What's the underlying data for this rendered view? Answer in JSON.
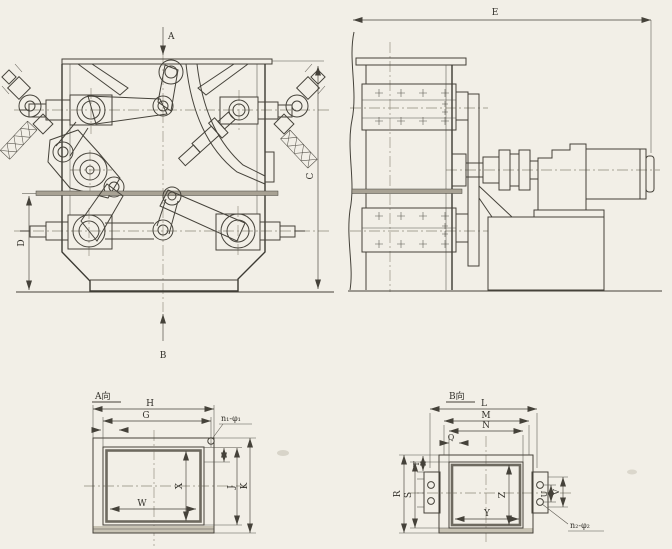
{
  "drawing": {
    "type": "mechanical-engineering-drawing",
    "paper_color": "#f2efe7",
    "ink_color": "#45423a",
    "centerline_color": "#8f8a7b",
    "views": {
      "front": {
        "label_a": "A",
        "label_b": "B",
        "dim_c": "C",
        "dim_d": "D"
      },
      "side": {
        "dim_e": "E"
      },
      "flange_a": {
        "title": "A向",
        "dim_h": "H",
        "dim_g": "G",
        "dim_w": "W",
        "dim_x": "X",
        "dim_j": "J",
        "dim_k": "K",
        "holes": "n₁-φ₁"
      },
      "flange_b": {
        "title": "B向",
        "dim_l": "L",
        "dim_m": "M",
        "dim_n": "N",
        "dim_q": "Q",
        "dim_r": "R",
        "dim_s": "S",
        "dim_t": "T",
        "dim_u": "U",
        "dim_v": "V",
        "dim_y": "Y",
        "dim_z": "Z",
        "holes": "n₂-φ₂"
      }
    }
  }
}
